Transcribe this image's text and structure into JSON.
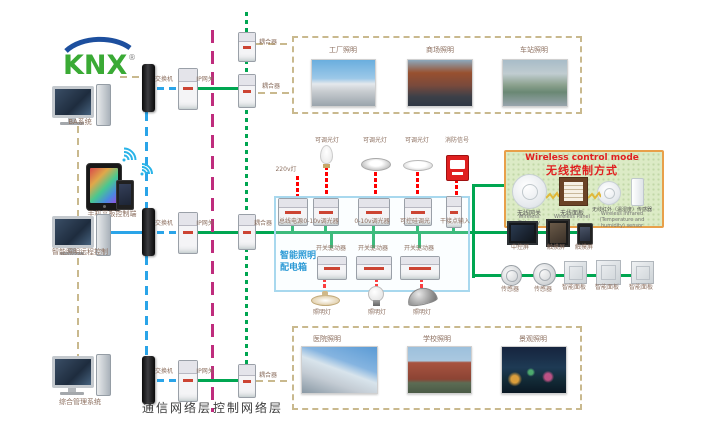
{
  "logo": {
    "text": "KNX",
    "registered": "®"
  },
  "layers": {
    "communication": "通信网络层",
    "control": "控制网络层"
  },
  "terminals": {
    "ba": "BA系统",
    "mobile": "手机平板控制端",
    "remote": "智能照明远程控制",
    "management": "综合管理系统"
  },
  "network_devices": {
    "switch": "交换机",
    "gateway": "IP网关",
    "coupler": "耦合器"
  },
  "scenes_top": [
    {
      "label": "工厂照明"
    },
    {
      "label": "商场照明"
    },
    {
      "label": "车站照明"
    }
  ],
  "scenes_bottom": [
    {
      "label": "医院照明"
    },
    {
      "label": "学校照明"
    },
    {
      "label": "景观照明"
    }
  ],
  "distribution_box": {
    "line1": "智能照明",
    "line2": "配电箱"
  },
  "field_inputs": {
    "power": "220v灯",
    "dimmable": "可调光灯",
    "fire": "消防信号"
  },
  "din_row1": [
    "总线电源",
    "0-10v调光器",
    "0-10v调光器",
    "可控硅调光",
    "干接点输入"
  ],
  "din_row2_label": "开关驱动器",
  "lamp_label": "照明灯",
  "wireless": {
    "title_en": "Wireless control mode",
    "title_zh": "无线控制方式",
    "gateway_zh": "无线网关",
    "gateway_en": "Wireless Gateway",
    "panel_zh": "无线面板",
    "panel_en": "Wireless Panel",
    "sensor_zh": "无线红外（温湿度）传感器",
    "sensor_en": "Wireless infrared (Temperature and humidity) sensor"
  },
  "right_devices": {
    "central_screen": "中控屏",
    "touch_screen": "触摸屏",
    "sensor": "传感器",
    "smart_panel": "智能面板"
  },
  "colors": {
    "bus_green": "#00a651",
    "comm_blue": "#2aa4e8",
    "control_magenta": "#bf2c7d",
    "field_tan": "#c9b98e",
    "power_red": "#ff0000",
    "dist_box_blue": "#a8d8ee",
    "wireless_border": "#e8a04a",
    "knx_green": "#3aaa35",
    "knx_blue": "#1d4f9e"
  }
}
